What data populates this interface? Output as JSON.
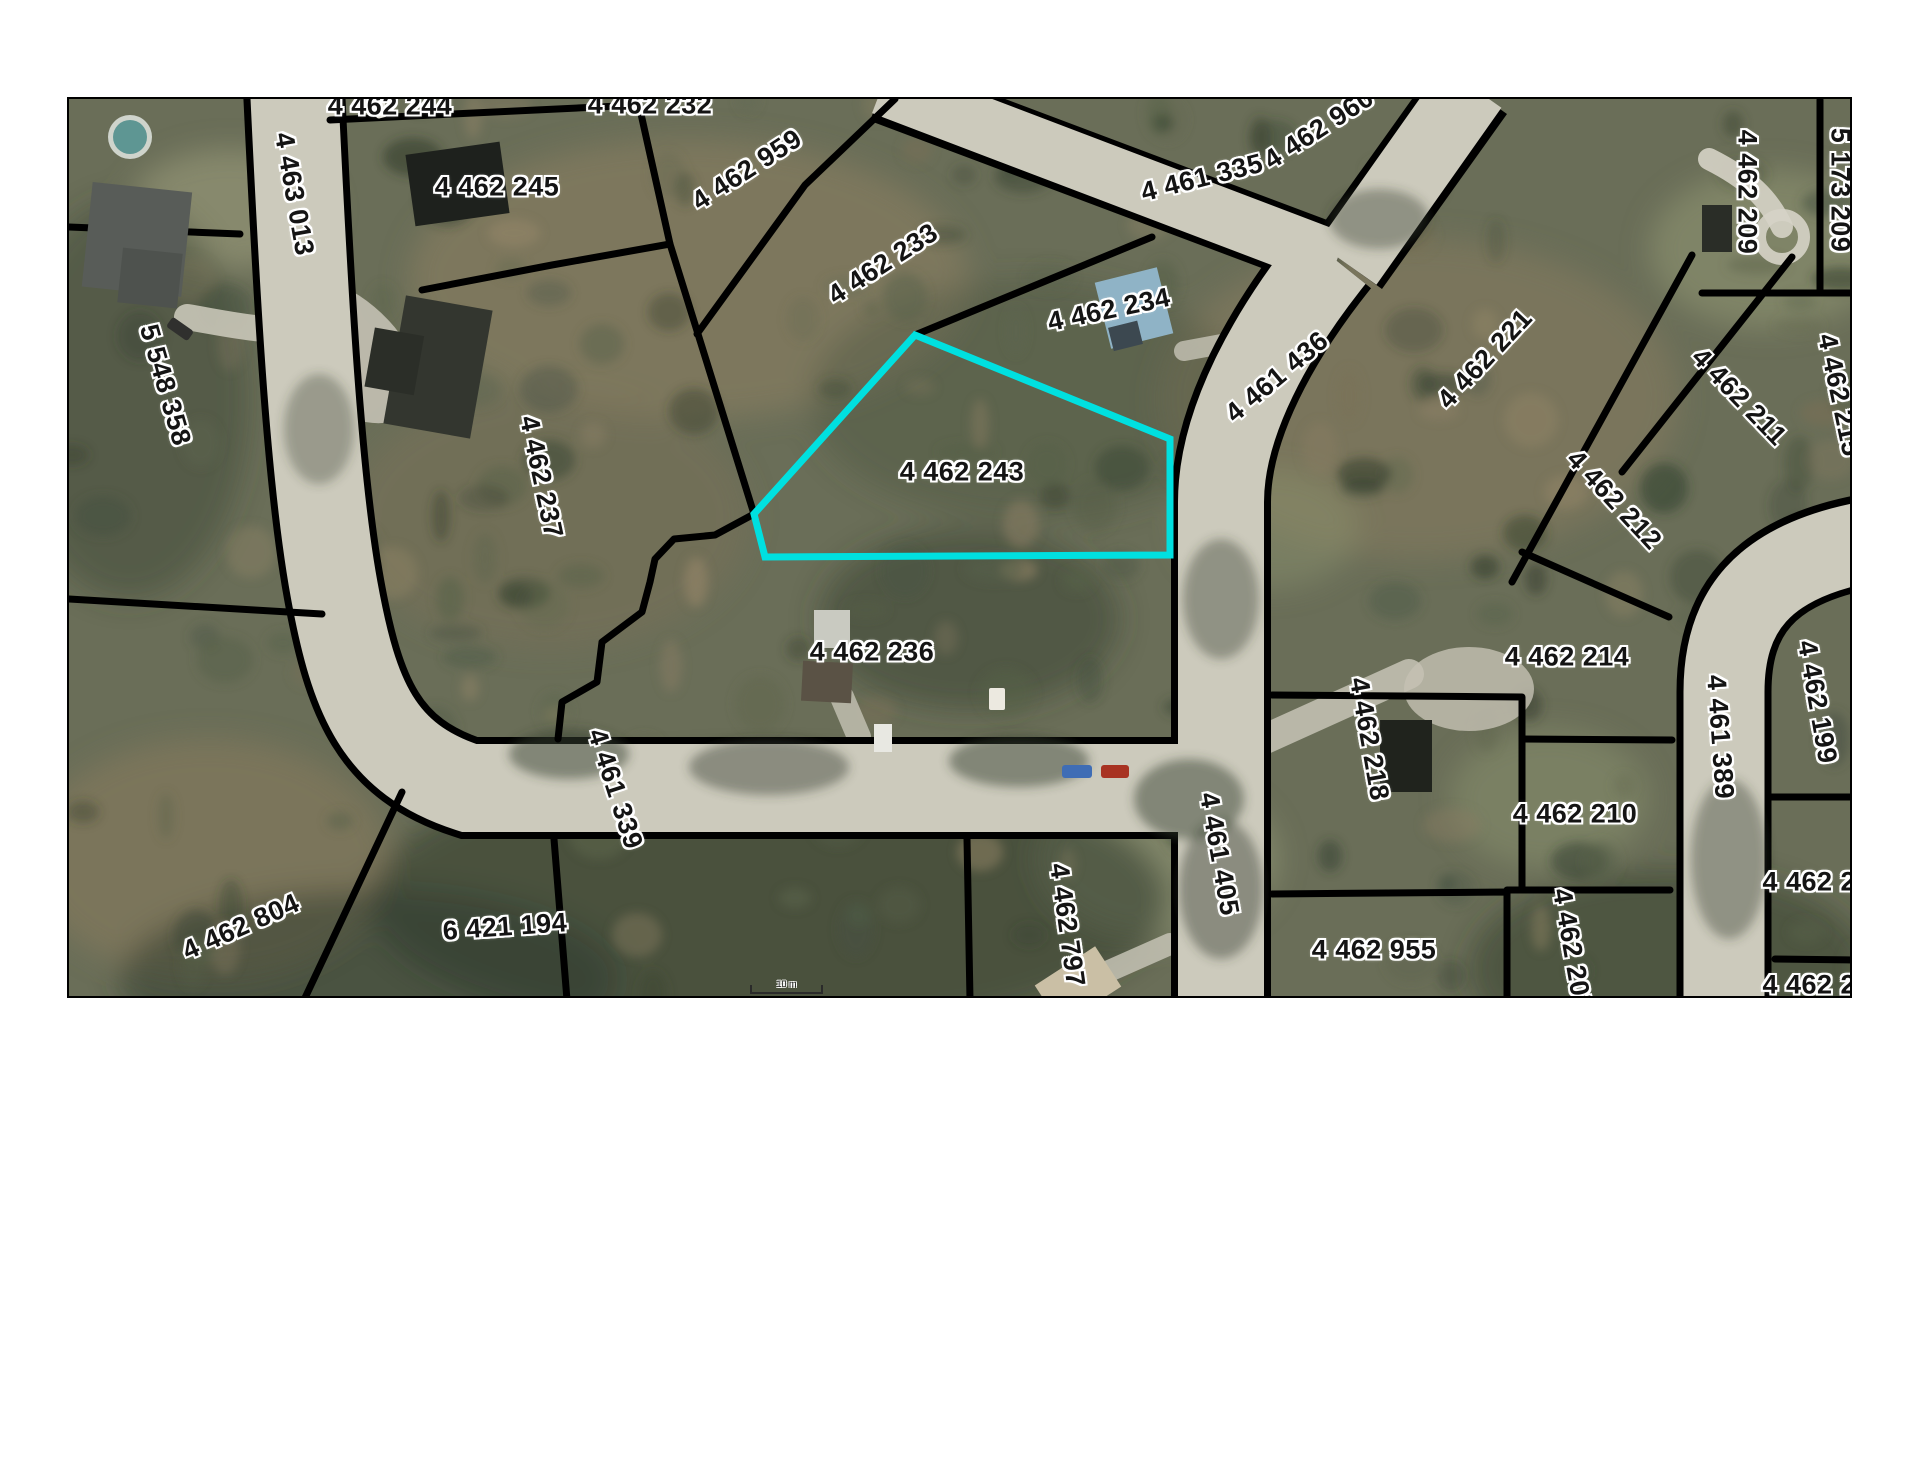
{
  "page": {
    "background": "#ffffff"
  },
  "map": {
    "frame": {
      "left": 67,
      "top": 97,
      "width": 1785,
      "height": 901,
      "border_color": "#000000"
    },
    "colors": {
      "highlight": "#00e0e0",
      "boundary": "#000000",
      "pavement": "#cccabc",
      "label_text": "#141414",
      "label_halo": "#ffffff",
      "forest_base": "#6a6e58"
    },
    "highlighted_parcel": {
      "id": "4 462 243",
      "vertices": [
        [
          846,
          236
        ],
        [
          1101,
          340
        ],
        [
          1101,
          456
        ],
        [
          696,
          458
        ],
        [
          685,
          415
        ]
      ]
    },
    "labels": [
      {
        "text": "4 462 244",
        "x": 321,
        "y": 7,
        "rot": 0
      },
      {
        "text": "4 462 232",
        "x": 581,
        "y": 6,
        "rot": 0
      },
      {
        "text": "4 462 245",
        "x": 428,
        "y": 88,
        "rot": 0
      },
      {
        "text": "4 462 959",
        "x": 678,
        "y": 71,
        "rot": -33
      },
      {
        "text": "4 462 233",
        "x": 814,
        "y": 165,
        "rot": -33
      },
      {
        "text": "4 461 335",
        "x": 1133,
        "y": 79,
        "rot": -14
      },
      {
        "text": "4 462 960",
        "x": 1250,
        "y": 30,
        "rot": -33
      },
      {
        "text": "4 462 234",
        "x": 1040,
        "y": 211,
        "rot": -12
      },
      {
        "text": "4 463 013",
        "x": 225,
        "y": 95,
        "rot": 80
      },
      {
        "text": "5 548 358",
        "x": 96,
        "y": 286,
        "rot": 74
      },
      {
        "text": "4 462 237",
        "x": 472,
        "y": 378,
        "rot": 78
      },
      {
        "text": "4 461 436",
        "x": 1208,
        "y": 278,
        "rot": -40
      },
      {
        "text": "4 462 221",
        "x": 1416,
        "y": 260,
        "rot": -47
      },
      {
        "text": "4 462 209",
        "x": 1678,
        "y": 93,
        "rot": 90
      },
      {
        "text": "5 173 209",
        "x": 1771,
        "y": 91,
        "rot": 90
      },
      {
        "text": "4 462 211",
        "x": 1670,
        "y": 298,
        "rot": 46
      },
      {
        "text": "4 462 215",
        "x": 1770,
        "y": 296,
        "rot": 78
      },
      {
        "text": "4 462 212",
        "x": 1545,
        "y": 401,
        "rot": 47
      },
      {
        "text": "4 462 243",
        "x": 893,
        "y": 373,
        "rot": 0
      },
      {
        "text": "4 462 236",
        "x": 803,
        "y": 553,
        "rot": 0
      },
      {
        "text": "4 462 214",
        "x": 1498,
        "y": 558,
        "rot": 0
      },
      {
        "text": "4 461 389",
        "x": 1651,
        "y": 638,
        "rot": 86
      },
      {
        "text": "4 462 199",
        "x": 1748,
        "y": 603,
        "rot": 80
      },
      {
        "text": "4 462 210",
        "x": 1506,
        "y": 715,
        "rot": 0
      },
      {
        "text": "4 461 339",
        "x": 546,
        "y": 690,
        "rot": 72
      },
      {
        "text": "4 462 218",
        "x": 1300,
        "y": 640,
        "rot": 80
      },
      {
        "text": "4 461 405",
        "x": 1150,
        "y": 755,
        "rot": 80
      },
      {
        "text": "4 462 797",
        "x": 998,
        "y": 826,
        "rot": 82
      },
      {
        "text": "4 462 955",
        "x": 1305,
        "y": 851,
        "rot": 0
      },
      {
        "text": "4 462 207",
        "x": 1503,
        "y": 851,
        "rot": 80
      },
      {
        "text": "4 462 20",
        "x": 1748,
        "y": 783,
        "rot": 0
      },
      {
        "text": "4 462 20",
        "x": 1748,
        "y": 886,
        "rot": 0
      },
      {
        "text": "6 421 194",
        "x": 436,
        "y": 828,
        "rot": -4
      },
      {
        "text": "4 462 804",
        "x": 172,
        "y": 828,
        "rot": -24
      }
    ],
    "scale_bar": {
      "label": "10 m"
    }
  }
}
